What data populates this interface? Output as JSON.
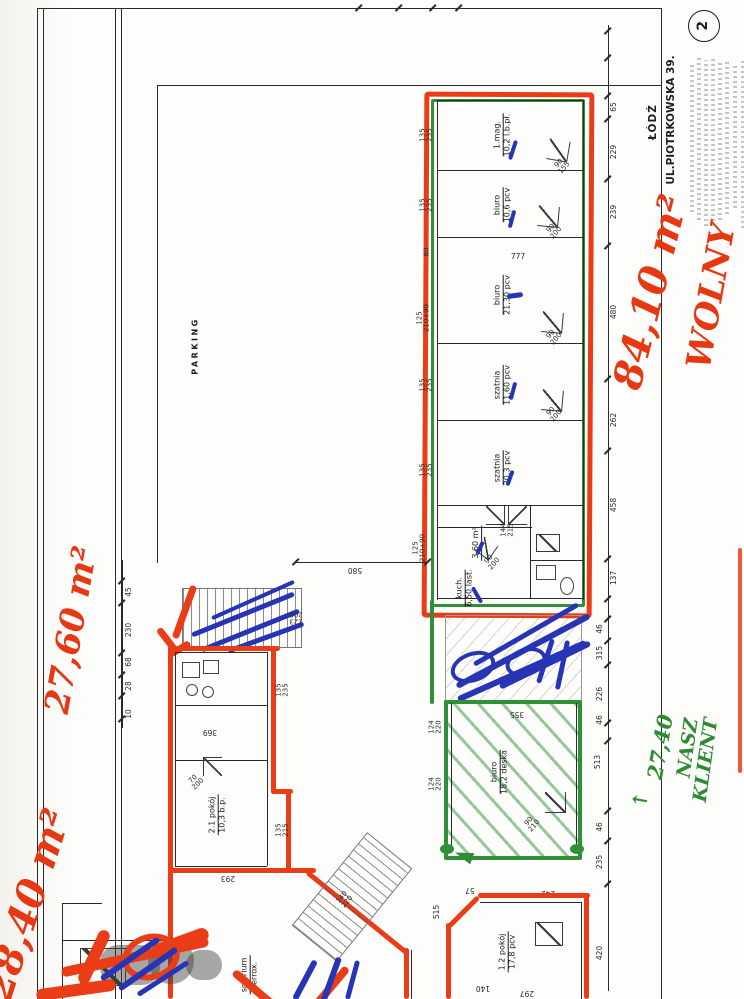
{
  "page": {
    "badge": "2"
  },
  "title_block": {
    "city": "ŁÓDŹ",
    "street": "UL.PIOTRKOWSKA 39."
  },
  "site": {
    "parking": "PARKING",
    "span": "580"
  },
  "hand": {
    "area_main": "84,10 m²",
    "status_main": "WOLNY",
    "area_left": "27,60 m²",
    "area_bottom": "28,40 m²",
    "area_green": "27,40",
    "green_word1": "NASZ",
    "green_word2": "KLIENT",
    "green_arrow": "↑"
  },
  "building_a": {
    "rooms": [
      {
        "name": "1.mag.",
        "area": "10,2 l.b.pł."
      },
      {
        "name": "biuro",
        "area": "10,6 pcv"
      },
      {
        "name": "biuro",
        "area": "21,30 pcv"
      },
      {
        "name": "szatnia",
        "area": "11,60 pcv"
      },
      {
        "name": "szatnia",
        "area": "20,3 pcv"
      },
      {
        "name": "3,60 m²",
        "area": ""
      },
      {
        "name": "kuch.",
        "area": "6,50 last."
      }
    ],
    "doors": [
      {
        "a": "90",
        "b": "155"
      },
      {
        "a": "90",
        "b": "200"
      },
      {
        "a": "90",
        "b": "200"
      },
      {
        "a": "90",
        "b": "200"
      },
      {
        "a": "144",
        "b": "215"
      },
      {
        "a": "90",
        "b": "200"
      }
    ],
    "windows": [
      {
        "a": "135",
        "b": "235"
      },
      {
        "a": "135",
        "b": "235"
      },
      {
        "a": "80",
        "b": ""
      },
      {
        "a": "125",
        "b": "210+90"
      },
      {
        "a": "135",
        "b": "235"
      },
      {
        "a": "135",
        "b": "235"
      },
      {
        "a": "125",
        "b": "210+90"
      }
    ],
    "mark": "777",
    "dims_right": [
      "65",
      "229",
      "239",
      "480",
      "262",
      "458",
      "137"
    ]
  },
  "mid_dims": [
    "46",
    "315",
    "226",
    "46",
    "513"
  ],
  "zone_green": {
    "room": {
      "name": "biuro",
      "area": "18,2 deska"
    },
    "window": "355",
    "door": {
      "a": "90",
      "b": "210"
    },
    "dims_left": [
      {
        "a": "124",
        "b": "220"
      },
      {
        "a": "124",
        "b": "220"
      }
    ],
    "bottom_dims": [
      "57",
      "242"
    ]
  },
  "building_b": {
    "stair_door": {
      "a": "123",
      "b": "200"
    },
    "rooms": [
      {
        "name": "2.1 pokój",
        "area": "10,3 b.p."
      },
      {
        "name": "solarium",
        "area": "terrox."
      }
    ],
    "door": {
      "a": "70",
      "b": "200"
    },
    "windows": [
      {
        "a": "135",
        "b": "235"
      },
      {
        "a": "135",
        "b": "215"
      }
    ],
    "dims": [
      "369",
      "293"
    ],
    "stair": {
      "a": "140",
      "b": "220"
    }
  },
  "zone_red": {
    "room": {
      "name": "1.2 pokój",
      "area": "17,8 pcv"
    },
    "dims": [
      "515",
      "140",
      "297"
    ],
    "dims_right": [
      "46",
      "235",
      "420"
    ]
  },
  "left_chain": [
    "45",
    "230",
    "68",
    "28",
    "10"
  ]
}
